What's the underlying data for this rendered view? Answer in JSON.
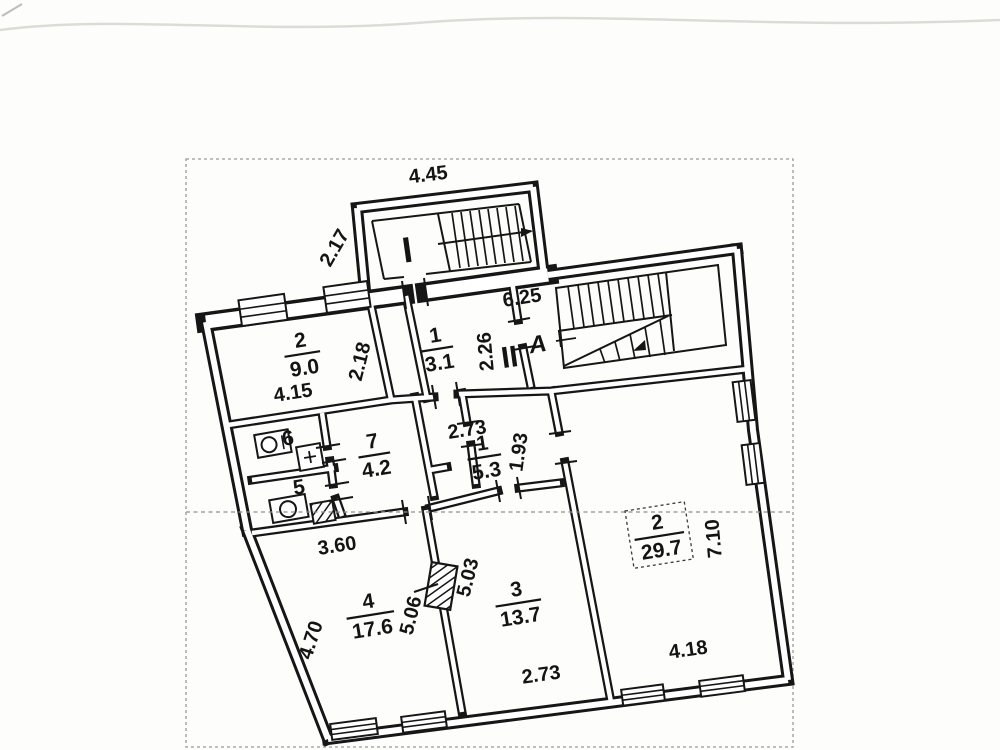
{
  "colors": {
    "ink": "#161616",
    "red": "#e02424",
    "dash": "#8f8f8f"
  },
  "markers": {
    "entrance_i": "I",
    "entrance_ii": "II",
    "stair_letter": "A"
  },
  "rooms": {
    "r9": {
      "num": "2",
      "area": "9.0"
    },
    "r31": {
      "num": "1",
      "area": "3.1"
    },
    "r42": {
      "num": "7",
      "area": "4.2"
    },
    "r53": {
      "num": "1",
      "area": "5.3"
    },
    "r176": {
      "num": "4",
      "area": "17.6"
    },
    "r137": {
      "num": "3",
      "area": "13.7"
    },
    "r297": {
      "num": "2",
      "area": "29.7"
    },
    "wc6": {
      "num": "6"
    },
    "wc5": {
      "num": "5"
    }
  },
  "dims": {
    "d445": "4.45",
    "d217": "2.17",
    "d625": "6.25",
    "d226": "2.26",
    "d218": "2.18",
    "d415": "4.15",
    "d273a": "2.73",
    "d193": "1.93",
    "d360": "3.60",
    "d506": "5.06",
    "d503": "5.03",
    "d470": "4.70",
    "d273b": "2.73",
    "d710": "7.10",
    "d418": "4.18"
  }
}
